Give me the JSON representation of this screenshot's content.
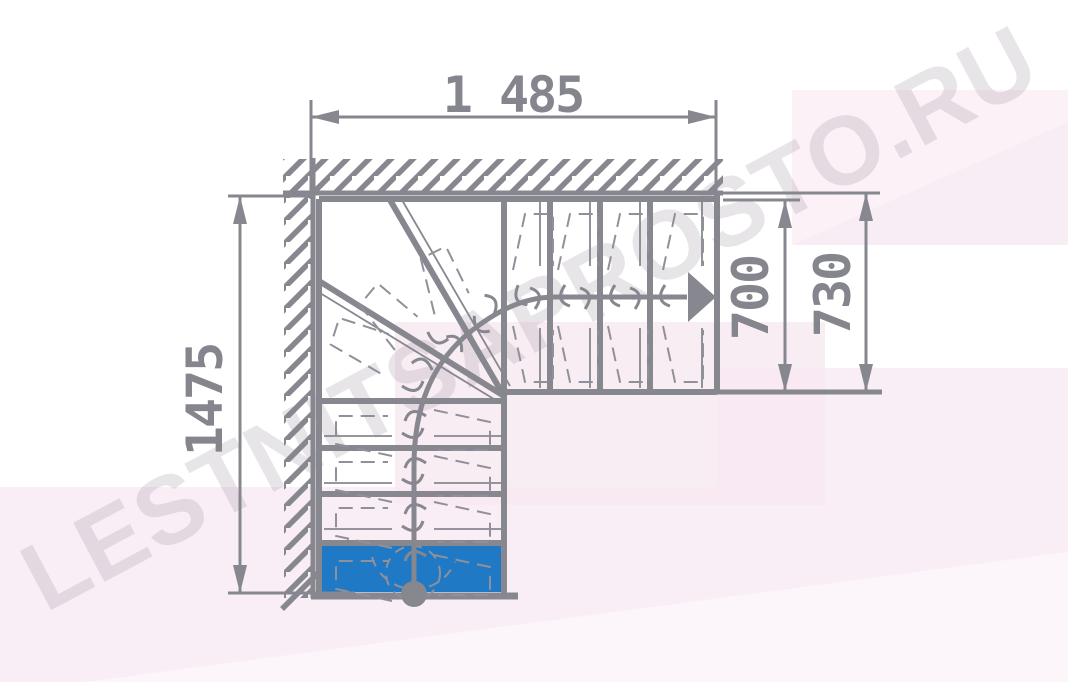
{
  "watermark": {
    "text": "LESTNITSAPROSTO.RU"
  },
  "colors": {
    "line_gray": "#87878f",
    "dimension_text": "#85858d",
    "highlighted_step_blue": "#1f79c5",
    "background_tint_main": "#f9eef5",
    "background_tint_mid": "#f7e7f0",
    "background_tint_topright": "#fbf1f7"
  },
  "plan": {
    "dimensions": {
      "total_width": "1 485",
      "total_depth": "1475",
      "flight_clear_width": "700",
      "flight_outer_width": "730"
    }
  }
}
